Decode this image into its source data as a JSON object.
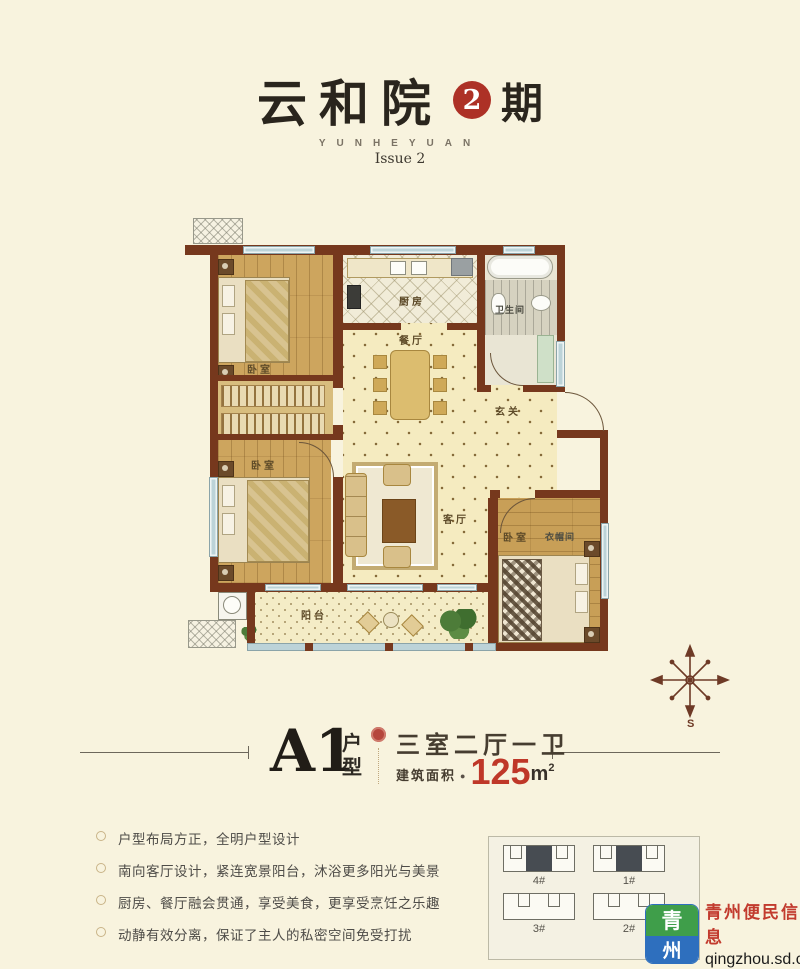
{
  "header": {
    "title_main": "云和院",
    "issue_number": "2",
    "issue_suffix": "期",
    "subtitle_en": "YUNHEYUAN",
    "subtitle_issue": "Issue 2"
  },
  "floorplan": {
    "labels": {
      "bedroom_north": "卧室",
      "bedroom_west": "卧室",
      "bedroom_south": "卧室",
      "cloakroom": "衣帽间",
      "kitchen": "厨房",
      "dining": "餐厅",
      "bath": "卫生间",
      "foyer": "玄关",
      "living": "客厅",
      "balcony": "阳台"
    },
    "compass": {
      "south_label": "S"
    }
  },
  "unit_info": {
    "unit_name": "A1",
    "unit_suffix": "户型",
    "layout": "三室二厅一卫",
    "area_label": "建筑面积",
    "area_separator": "●",
    "area_value": "125",
    "area_unit": "m",
    "area_sup": "2"
  },
  "features": [
    "户型布局方正，全明户型设计",
    "南向客厅设计，紧连宽景阳台，沐浴更多阳光与美景",
    "厨房、餐厅融会贯通，享受美食，更享受烹饪之乐趣",
    "动静有效分离，保证了主人的私密空间免受打扰"
  ],
  "site_plan": {
    "buildings": [
      "4#",
      "1#",
      "3#",
      "2#"
    ]
  },
  "watermark": {
    "logo_top": "青",
    "logo_bottom": "州",
    "brand": "青州便民信息",
    "url": "qingzhou.sd.cn"
  },
  "colors": {
    "background_cream": "#f8f3de",
    "wall_brown": "#76381d",
    "accent_red": "#ad3126",
    "area_red": "#bf3728",
    "logo_green": "#3f9e4a",
    "logo_blue": "#2e6fbe",
    "brand_red": "#c23b2e"
  }
}
